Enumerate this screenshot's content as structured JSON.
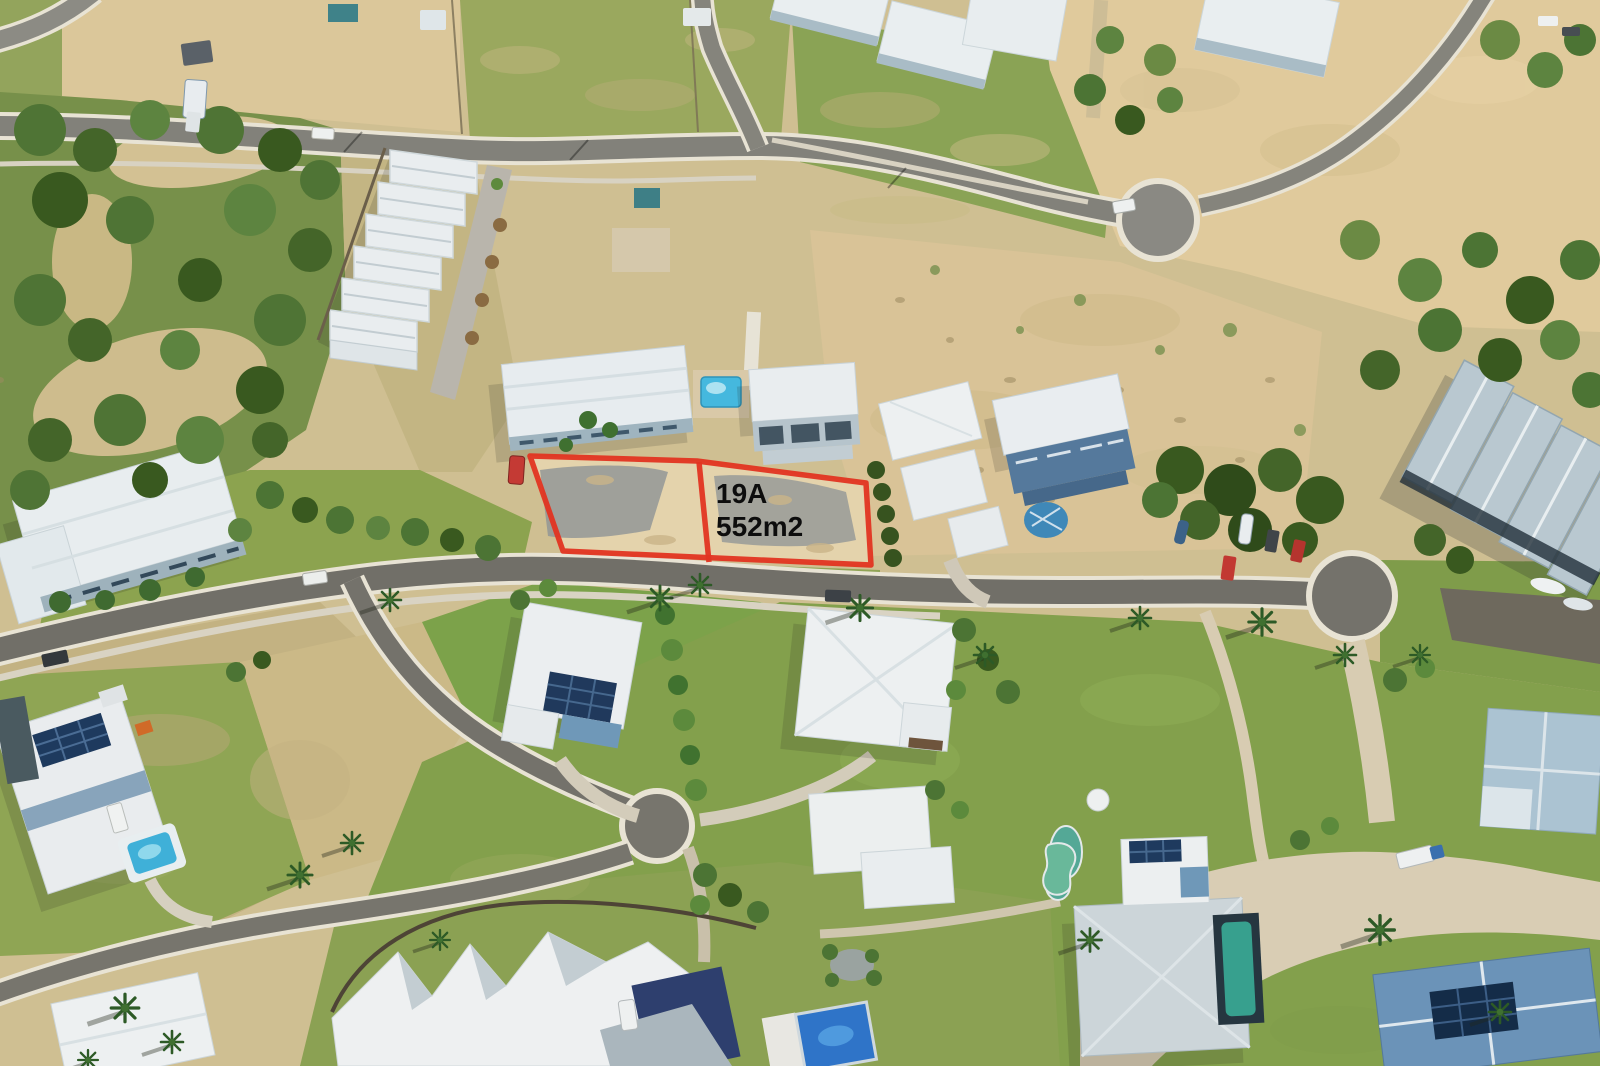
{
  "scene": {
    "type": "aerial-drone-photograph",
    "subject": "coastal residential estate with vacant land and highlighted lot boundary",
    "width_px": 1600,
    "height_px": 1066
  },
  "lot_marker": {
    "lot_id": "19A",
    "lot_area": "552m2",
    "outline_color": "#e23421",
    "label_color": "#0d0d0d"
  },
  "palette": {
    "sand": "#d9c597",
    "dune_sand": "#e0ca9c",
    "lot_sand": "#e4d3ac",
    "dry_grass": "#b0a96e",
    "grass": "#8ba153",
    "lawn": "#7ca24a",
    "tree_green": "#4c7434",
    "deep_tree_green": "#39591f",
    "asphalt": "#76756e",
    "kerb_white": "#e8e3d4",
    "concrete": "#d8ccb2",
    "roof_white": "#eceff1",
    "roof_grey": "#ccd5d9",
    "roof_blue": "#6b93b8",
    "wall_blue": "#55799c",
    "pool_blue": "#45b8de",
    "pool_teal": "#37a08e",
    "solar_panel": "#1e3a5e",
    "building_shadow": "#8d9396"
  }
}
